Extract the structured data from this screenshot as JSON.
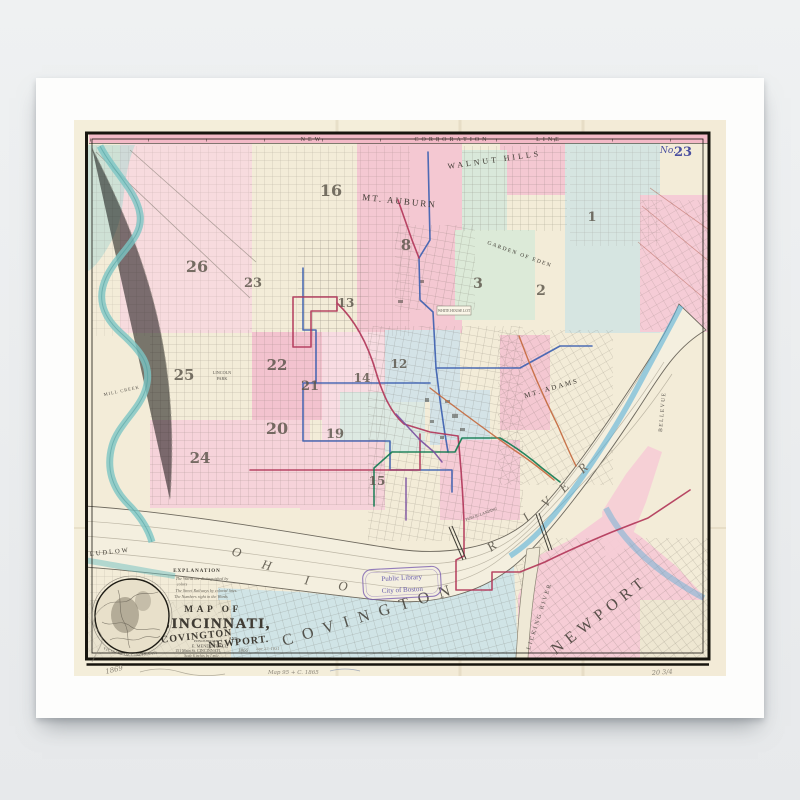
{
  "map": {
    "plate_no_prefix": "No.",
    "plate_no": "23",
    "corporation_line": {
      "w1": "NEW",
      "w2": "CORPORATION",
      "w3": "LINE"
    },
    "places": {
      "walnut_hills": "WALNUT HILLS",
      "mt_auburn": "MT. AUBURN",
      "garden_of_eden": "GARDEN OF EDEN",
      "mt_adams": "MT. ADAMS",
      "lincoln_park_1": "LINCOLN",
      "lincoln_park_2": "PARK",
      "mill_creek": "MILL CREEK",
      "ludlow": "LUDLOW",
      "covington": "COVINGTON",
      "newport": "NEWPORT",
      "licking_river": "LICKING RIVER",
      "bellevue": "BELLEVUE",
      "public_landing": "PUBLIC LANDING",
      "white_house_lot": "WHITE HOUSE LOT"
    },
    "ohio_letters": [
      "O",
      "H",
      "I",
      "O"
    ],
    "river_letters": [
      "R",
      "I",
      "V",
      "E",
      "R"
    ],
    "wards": {
      "w1": "1",
      "w2": "2",
      "w3": "3",
      "w8": "8",
      "w12": "12",
      "w13": "13",
      "w14": "14",
      "w15": "15",
      "w16": "16",
      "w19": "19",
      "w20": "20",
      "w21": "21",
      "w22": "22",
      "w23": "23",
      "w24": "24",
      "w25": "25",
      "w26": "26"
    },
    "title_block": {
      "heading": "EXPLANATION",
      "line1": "The Wards are distinguished by",
      "line2": "colors",
      "line3": "The Street Railways by colored lines",
      "line4": "The Numbers right in the Wards",
      "map_of": "MAP OF",
      "city1": "CINCINNATI,",
      "city2": "COVINGTON",
      "and_word": "AND",
      "city3": "NEWPORT.",
      "published_by": "PUBLISHED BY",
      "publisher": "E. MENDENHALL,",
      "address": "151 Main St. CINCINNATI,",
      "year": "1866",
      "scale": "Scale 6 inches by 1 mile."
    },
    "inset_caption": "VICINITY OF CINCINNATI",
    "stamps": {
      "library_1": "Public Library",
      "library_2": "City of Boston"
    },
    "pencil": {
      "year": "1869",
      "catalog": "Map 95 + C. 1865",
      "size": "20 3/4",
      "date": "Apr 27, 1931"
    }
  },
  "colors": {
    "ward_pink": "#f5ccd6",
    "ward_blue": "#d4e3e7",
    "ward_green": "#dcead8",
    "railway_red": "#b13558",
    "railway_blue": "#3b5fb0",
    "railway_green": "#107a50",
    "railway_purple": "#7a4fa0",
    "water_teal": "#7cc5c4",
    "water_blue": "#58b0d8",
    "stamp_purple": "#6a5fae",
    "band_pink": "#f3bac7"
  }
}
